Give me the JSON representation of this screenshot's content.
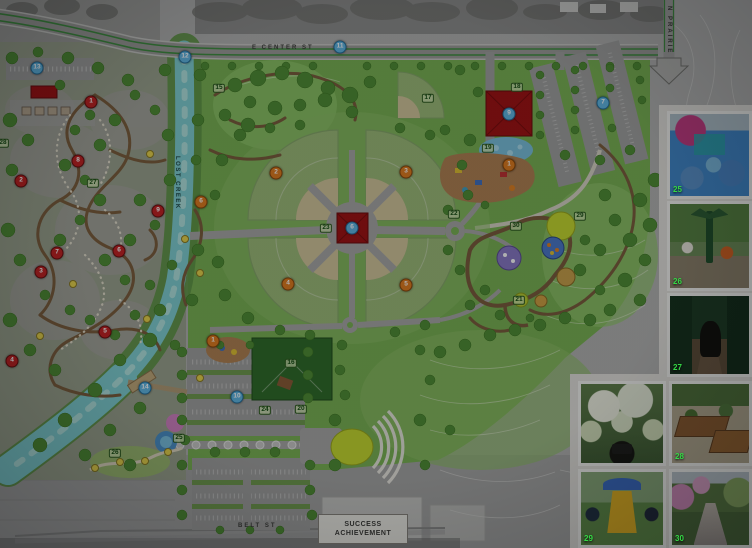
{
  "map": {
    "street_labels": [
      {
        "id": "e-center-st",
        "text": "E CENTER ST",
        "x": 252,
        "y": 45,
        "vertical": false
      },
      {
        "id": "lost-creek",
        "text": "LOST CREEK",
        "x": 180,
        "y": 156,
        "vertical": true
      },
      {
        "id": "n-prairie",
        "text": "N PRAIRIE",
        "x": 672,
        "y": 6,
        "vertical": true
      },
      {
        "id": "belt-st",
        "text": "BELT ST",
        "x": 238,
        "y": 523,
        "vertical": false
      }
    ],
    "sign": {
      "line1": "SUCCESS",
      "line2": "ACHIEVEMENT"
    },
    "markers": [
      {
        "n": "1",
        "kind": "red",
        "x": 91,
        "y": 102
      },
      {
        "n": "8",
        "kind": "red",
        "x": 78,
        "y": 161
      },
      {
        "n": "2",
        "kind": "red",
        "x": 21,
        "y": 181
      },
      {
        "n": "9",
        "kind": "red",
        "x": 158,
        "y": 211
      },
      {
        "n": "7",
        "kind": "red",
        "x": 57,
        "y": 253
      },
      {
        "n": "6",
        "kind": "red",
        "x": 119,
        "y": 251
      },
      {
        "n": "3",
        "kind": "red",
        "x": 41,
        "y": 272
      },
      {
        "n": "5",
        "kind": "red",
        "x": 105,
        "y": 332
      },
      {
        "n": "4",
        "kind": "red",
        "x": 12,
        "y": 361
      },
      {
        "n": "6",
        "kind": "orange",
        "x": 201,
        "y": 202
      },
      {
        "n": "2",
        "kind": "orange",
        "x": 276,
        "y": 173
      },
      {
        "n": "3",
        "kind": "orange",
        "x": 406,
        "y": 172
      },
      {
        "n": "4",
        "kind": "orange",
        "x": 288,
        "y": 284
      },
      {
        "n": "5",
        "kind": "orange",
        "x": 406,
        "y": 285
      },
      {
        "n": "1",
        "kind": "orange",
        "x": 509,
        "y": 165
      },
      {
        "n": "1",
        "kind": "orange",
        "x": 213,
        "y": 341
      },
      {
        "n": "11",
        "kind": "blue",
        "x": 340,
        "y": 47
      },
      {
        "n": "12",
        "kind": "blue",
        "x": 185,
        "y": 57
      },
      {
        "n": "13",
        "kind": "blue",
        "x": 37,
        "y": 68
      },
      {
        "n": "7",
        "kind": "blue",
        "x": 603,
        "y": 103
      },
      {
        "n": "9",
        "kind": "blue",
        "x": 509,
        "y": 114
      },
      {
        "n": "6",
        "kind": "blue",
        "x": 352,
        "y": 228
      },
      {
        "n": "10",
        "kind": "blue",
        "x": 237,
        "y": 397
      },
      {
        "n": "14",
        "kind": "blue",
        "x": 145,
        "y": 388
      }
    ],
    "ref_labels": [
      {
        "n": "15",
        "x": 219,
        "y": 88
      },
      {
        "n": "17",
        "x": 428,
        "y": 98
      },
      {
        "n": "18",
        "x": 517,
        "y": 87
      },
      {
        "n": "19",
        "x": 488,
        "y": 148
      },
      {
        "n": "22",
        "x": 454,
        "y": 214
      },
      {
        "n": "23",
        "x": 326,
        "y": 228
      },
      {
        "n": "27",
        "x": 93,
        "y": 183
      },
      {
        "n": "28",
        "x": 3,
        "y": 143
      },
      {
        "n": "29",
        "x": 580,
        "y": 216
      },
      {
        "n": "30",
        "x": 516,
        "y": 226
      },
      {
        "n": "21",
        "x": 519,
        "y": 300
      },
      {
        "n": "16",
        "x": 291,
        "y": 363
      },
      {
        "n": "24",
        "x": 265,
        "y": 410
      },
      {
        "n": "20",
        "x": 301,
        "y": 409
      },
      {
        "n": "25",
        "x": 179,
        "y": 438
      },
      {
        "n": "26",
        "x": 115,
        "y": 453
      }
    ],
    "colors": {
      "marker_red": "#c22020",
      "marker_orange": "#e07b1c",
      "marker_blue": "#5fb6e2",
      "label_green": "#134a0e",
      "park_green": "#79b251",
      "creek_teal": "#7ecfd1",
      "building_red": "#a01010",
      "stage_yellow": "#c6d92c"
    }
  },
  "photos": [
    {
      "id": "splash-pad",
      "number": "25",
      "x": 667,
      "y": 111,
      "w": 85,
      "h": 88
    },
    {
      "id": "accessible-swings",
      "number": "26",
      "x": 667,
      "y": 201,
      "w": 85,
      "h": 90
    },
    {
      "id": "disc-golf",
      "number": "27",
      "x": 667,
      "y": 293,
      "w": 85,
      "h": 84
    },
    {
      "id": "flower-arbor-bench",
      "number": "",
      "x": 578,
      "y": 381,
      "w": 88,
      "h": 85
    },
    {
      "id": "raised-garden-beds",
      "number": "28",
      "x": 669,
      "y": 381,
      "w": 83,
      "h": 85
    },
    {
      "id": "adaptive-swing",
      "number": "29",
      "x": 578,
      "y": 469,
      "w": 88,
      "h": 79
    },
    {
      "id": "blossom-walkway",
      "number": "30",
      "x": 669,
      "y": 469,
      "w": 83,
      "h": 79
    }
  ]
}
